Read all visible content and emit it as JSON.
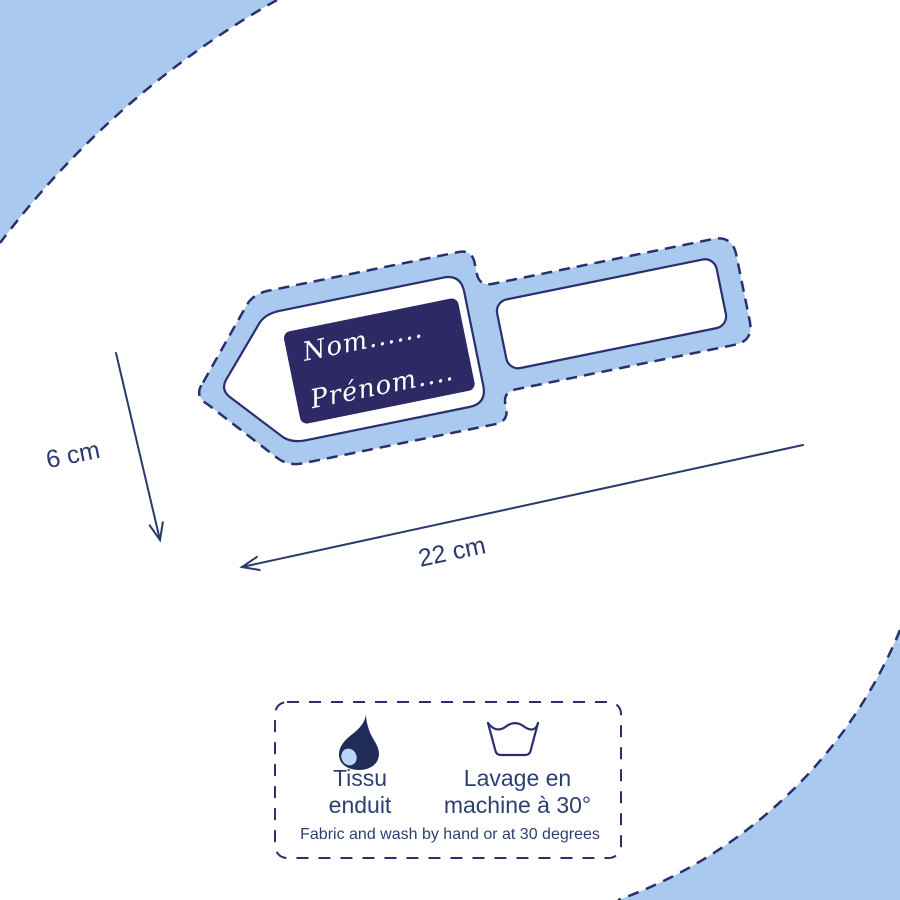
{
  "colors": {
    "accent_blue": "#a9c9ef",
    "navy_line": "#2a2f6e",
    "plate_navy": "#2d2964",
    "text_navy": "#2e4070",
    "drop_highlight": "#b9d5f3",
    "background": "#ffffff"
  },
  "tag": {
    "name_field": "Nom......",
    "firstname_field": "Prénom...."
  },
  "dimensions": {
    "height": "6 cm",
    "width": "22 cm"
  },
  "care_box": {
    "fabric": {
      "icon": "water-drop-icon",
      "line1": "Tissu",
      "line2": "enduit"
    },
    "wash": {
      "icon": "wash-tub-icon",
      "line1": "Lavage en",
      "line2": "machine à 30°"
    },
    "footnote": "Fabric and wash by hand or at 30 degrees"
  }
}
